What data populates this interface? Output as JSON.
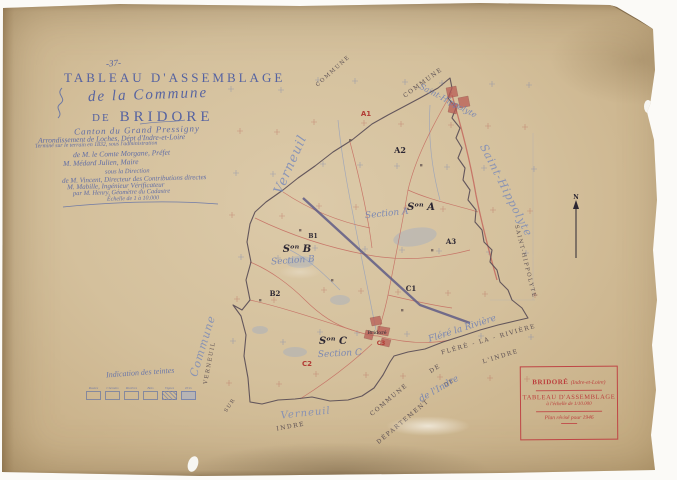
{
  "page_number": "-37-",
  "title_block": {
    "title": "TABLEAU D'ASSEMBLAGE",
    "subtitle": "de la Commune",
    "de": "DE",
    "commune": "BRIDORE",
    "hand_lines": [
      "Canton du Grand Pressigny",
      "Arrondissement de Loches, Dépt d'Indre-et-Loire",
      "Terminé sur le terrain en 1832, sous l'administration",
      "de M. le Comte Morgane, Préfet",
      "M. Médard Julien, Maire",
      "sous la Direction",
      "de M. Vincent, Directeur des Contributions directes",
      "M. Mabille, Ingénieur Vérificateur",
      "par M. Henry, Géomètre du Cadastre",
      "Échelle de 1 à 10.000"
    ]
  },
  "tint_legend": {
    "title": "Indication des teintes",
    "labels": [
      "Routes",
      "Chemins",
      "Rivières",
      "Bois",
      "Vignes",
      "Prés"
    ]
  },
  "stamp_box": {
    "commune": "BRIDORÉ",
    "dept": "(Indre-et-Loire)",
    "line2": "TABLEAU D'ASSEMBLAGE",
    "scale": "à l'échelle de 1/10.000",
    "revision": "Plan révisé pour 1946"
  },
  "map": {
    "north_label": "N",
    "labels": [
      {
        "t": "COMMUNE",
        "x": 334,
        "y": 72,
        "c": "cap",
        "s": 5.5,
        "r": -42
      },
      {
        "t": "COMMUNE",
        "x": 424,
        "y": 84,
        "c": "cap",
        "s": 6,
        "r": -36
      },
      {
        "t": "Saint-Hippolyte",
        "x": 447,
        "y": 103,
        "c": "cur",
        "s": 8,
        "r": 28
      },
      {
        "t": "Saint-Hippolyte",
        "x": 503,
        "y": 192,
        "c": "curbig",
        "s": 11,
        "r": 63
      },
      {
        "t": "SAINT-HIPPOLYTE",
        "x": 524,
        "y": 262,
        "c": "cap",
        "s": 5.5,
        "r": 76
      },
      {
        "t": "Verneuil",
        "x": 294,
        "y": 166,
        "c": "curbig",
        "s": 13,
        "r": -66
      },
      {
        "t": "Commune",
        "x": 206,
        "y": 347,
        "c": "curbig",
        "s": 11,
        "r": -73
      },
      {
        "t": "VERNEUIL",
        "x": 211,
        "y": 363,
        "c": "cap",
        "s": 5.5,
        "r": -79
      },
      {
        "t": "SUR",
        "x": 231,
        "y": 406,
        "c": "cap",
        "s": 5,
        "r": -55
      },
      {
        "t": "INDRE",
        "x": 291,
        "y": 428,
        "c": "cap",
        "s": 6,
        "r": -10
      },
      {
        "t": "Verneuil",
        "x": 306,
        "y": 416,
        "c": "curbig",
        "s": 10,
        "r": -6
      },
      {
        "t": "COMMUNE",
        "x": 390,
        "y": 401,
        "c": "cap",
        "s": 6,
        "r": -40
      },
      {
        "t": "DE",
        "x": 436,
        "y": 370,
        "c": "cap",
        "s": 6,
        "r": -32
      },
      {
        "t": "FLÉRÉ - LA - RIVIÈRE",
        "x": 489,
        "y": 341,
        "c": "cap",
        "s": 6,
        "r": -16
      },
      {
        "t": "DÉPARTEMENT",
        "x": 404,
        "y": 423,
        "c": "cap",
        "s": 6,
        "r": -40
      },
      {
        "t": "DE",
        "x": 450,
        "y": 384,
        "c": "cap",
        "s": 5.5,
        "r": -32
      },
      {
        "t": "L'INDRE",
        "x": 501,
        "y": 358,
        "c": "cap",
        "s": 6,
        "r": -17
      },
      {
        "t": "Fléré la Rivière",
        "x": 463,
        "y": 331,
        "c": "cur",
        "s": 9,
        "r": -18
      },
      {
        "t": "de l'Indre",
        "x": 440,
        "y": 391,
        "c": "cur",
        "s": 9,
        "r": -30
      },
      {
        "t": "A1",
        "x": 366,
        "y": 116,
        "c": "red",
        "s": 7,
        "r": 0
      },
      {
        "t": "A2",
        "x": 400,
        "y": 153,
        "c": "blk",
        "s": 8,
        "r": 0
      },
      {
        "t": "Sᵒⁿ A",
        "x": 421,
        "y": 210,
        "c": "sec",
        "s": 10,
        "r": 0
      },
      {
        "t": "Section A",
        "x": 387,
        "y": 216,
        "c": "cur",
        "s": 9,
        "r": -6
      },
      {
        "t": "A3",
        "x": 451,
        "y": 244,
        "c": "blk",
        "s": 7,
        "r": 0
      },
      {
        "t": "B1",
        "x": 313,
        "y": 238,
        "c": "blk",
        "s": 6,
        "r": 0
      },
      {
        "t": "Sᵒⁿ B",
        "x": 297,
        "y": 252,
        "c": "sec",
        "s": 10,
        "r": 0
      },
      {
        "t": "Section B",
        "x": 293,
        "y": 263,
        "c": "cur",
        "s": 9,
        "r": -4
      },
      {
        "t": "B2",
        "x": 275,
        "y": 296,
        "c": "blk",
        "s": 7,
        "r": 0
      },
      {
        "t": "C1",
        "x": 411,
        "y": 291,
        "c": "blk",
        "s": 7,
        "r": 0
      },
      {
        "t": "Sᵒⁿ C",
        "x": 333,
        "y": 344,
        "c": "sec",
        "s": 10,
        "r": 0
      },
      {
        "t": "Section C",
        "x": 340,
        "y": 356,
        "c": "cur",
        "s": 9,
        "r": -3
      },
      {
        "t": "C2",
        "x": 307,
        "y": 366,
        "c": "red",
        "s": 7,
        "r": 0
      },
      {
        "t": "Bridoré",
        "x": 377,
        "y": 334,
        "c": "tiny",
        "s": 5,
        "r": 0
      },
      {
        "t": "C3",
        "x": 381,
        "y": 345,
        "c": "red",
        "s": 6,
        "r": 0
      },
      {
        "t": "N",
        "x": 576,
        "y": 199,
        "c": "blk",
        "s": 6,
        "r": 0
      }
    ]
  },
  "colors": {
    "paper": "#d4c09c",
    "ink_blue": "#4a5aa2",
    "stamp_red": "#bf4545",
    "road_red": "#c4695f",
    "water_blue": "#7d93c4",
    "railway": "#5f5c86",
    "boundary": "#564a54"
  }
}
